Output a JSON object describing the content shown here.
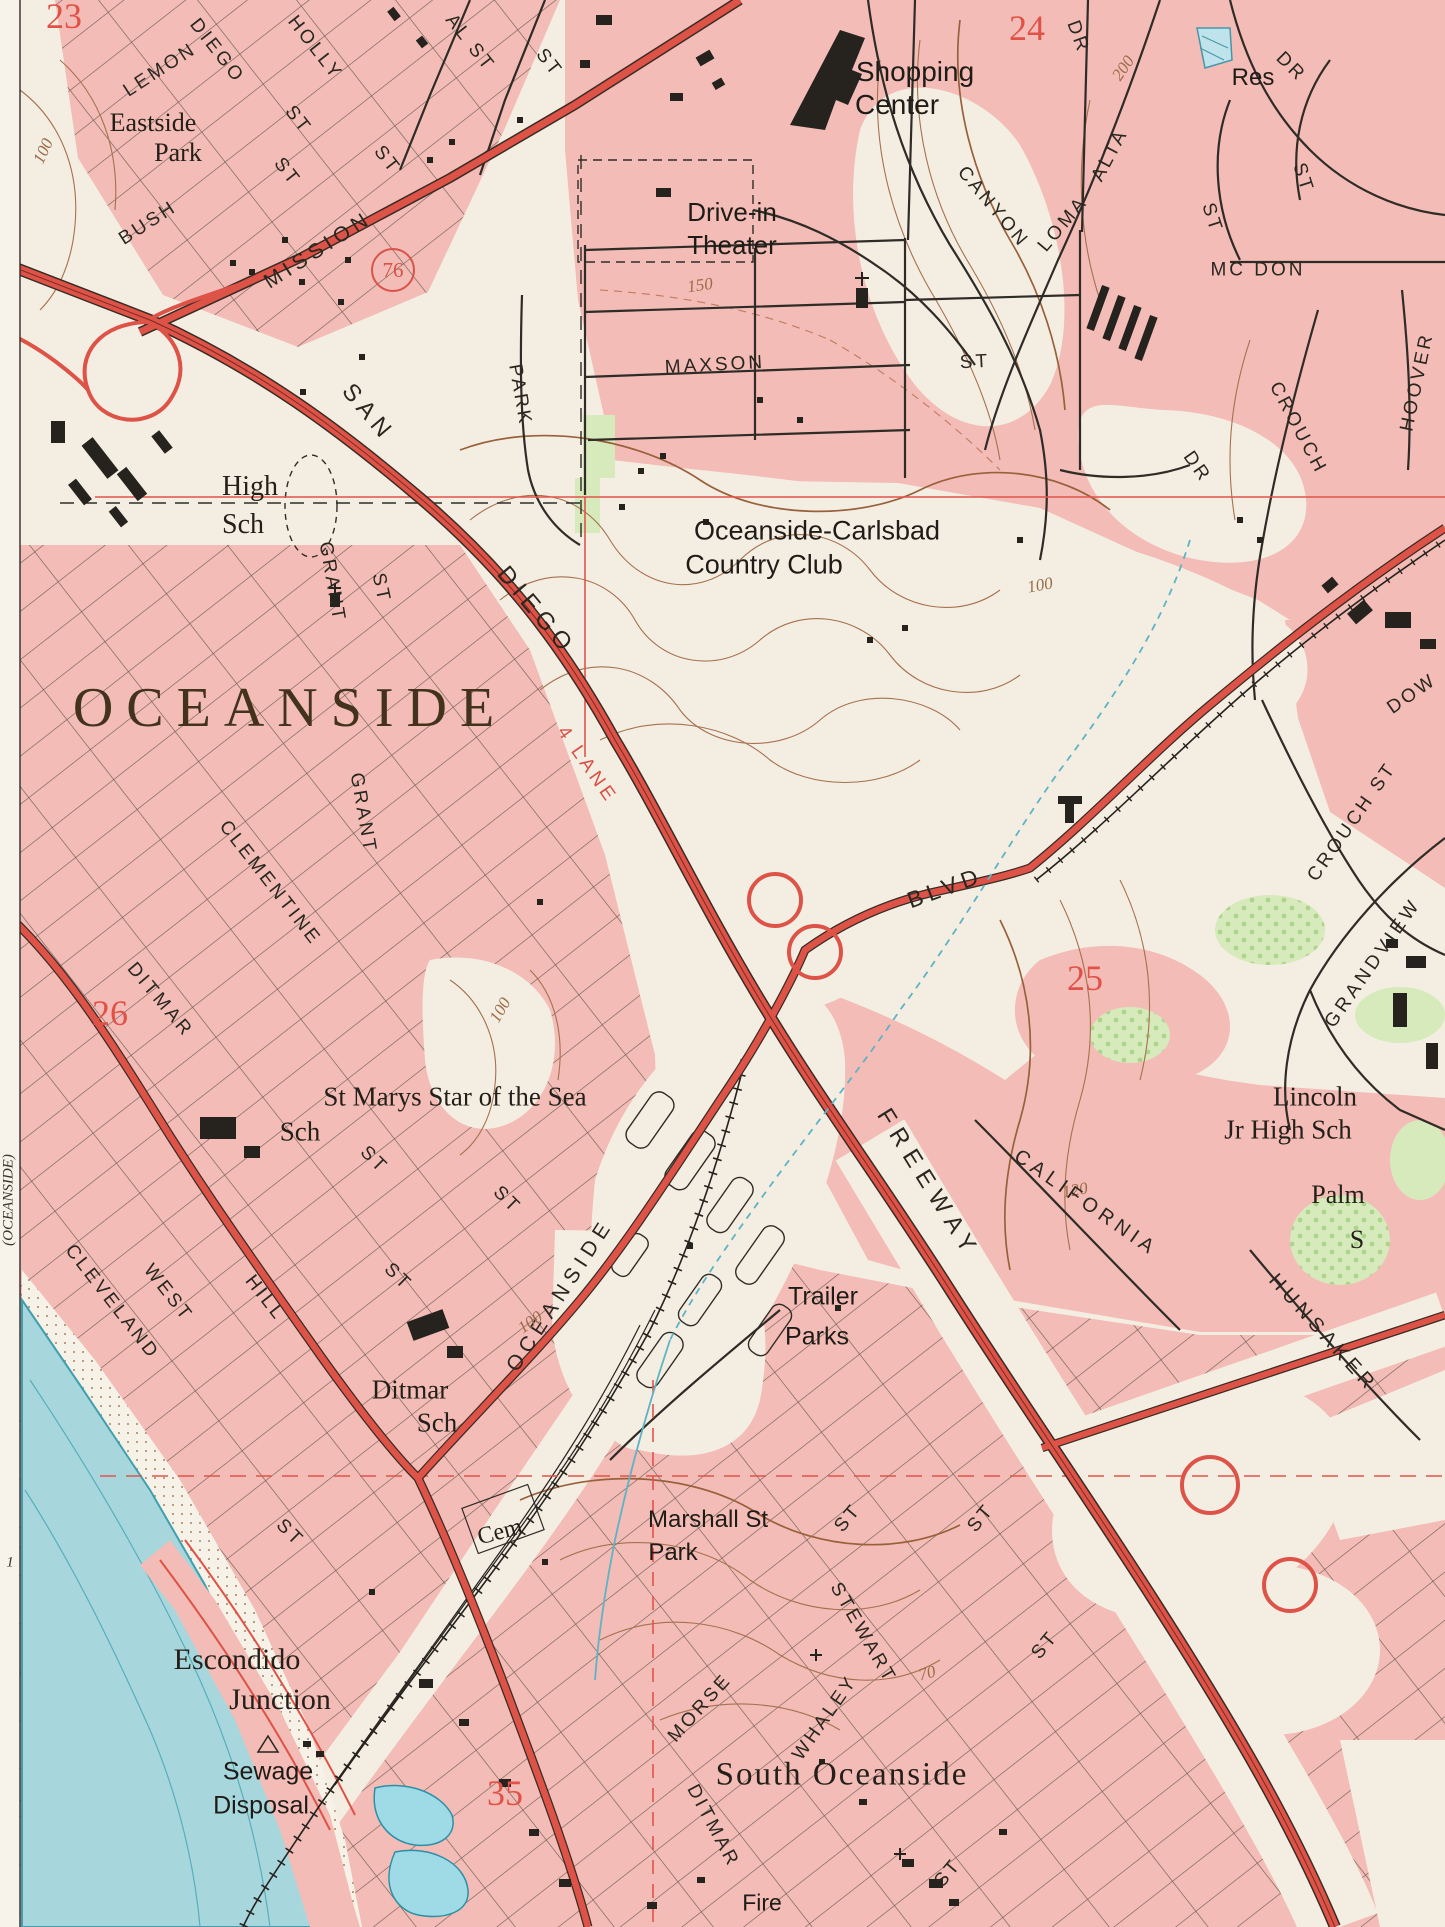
{
  "map": {
    "type": "usgs-topographic-map",
    "region": "Oceanside, California",
    "colors": {
      "paper": "#f4eee2",
      "urban_tint": "#f3bcb6",
      "highway_red": "#dd5348",
      "contour_brown": "#a5714f",
      "water_blue": "#a7d7dc",
      "park_green": "#d7eabc",
      "ink": "#26231f",
      "section_red": "#e05247"
    },
    "route_shield": "76",
    "labels": [
      {
        "id": "sec-23",
        "t": "23",
        "x": 64,
        "y": 16,
        "r": 0,
        "c": "section"
      },
      {
        "id": "st-lemon",
        "t": "LEMON",
        "x": 160,
        "y": 70,
        "r": -33,
        "c": "street"
      },
      {
        "id": "st-diego-n",
        "t": "DIEGO",
        "x": 217,
        "y": 51,
        "r": 52,
        "c": "street"
      },
      {
        "id": "st-holly",
        "t": "HOLLY",
        "x": 315,
        "y": 48,
        "r": 52,
        "c": "street"
      },
      {
        "id": "st-al-st",
        "t": "AL ST",
        "x": 470,
        "y": 43,
        "r": 52,
        "c": "street"
      },
      {
        "id": "st-st1",
        "t": "ST",
        "x": 549,
        "y": 63,
        "r": 52,
        "c": "street"
      },
      {
        "id": "pl-eastside",
        "t": "Eastside",
        "x": 153,
        "y": 123,
        "r": 0,
        "c": "place2",
        "fs": 26
      },
      {
        "id": "pl-eastside2",
        "t": "Park",
        "x": 178,
        "y": 153,
        "r": 0,
        "c": "place2",
        "fs": 26
      },
      {
        "id": "st-st2",
        "t": "ST",
        "x": 298,
        "y": 120,
        "r": 52,
        "c": "street"
      },
      {
        "id": "st-st3",
        "t": "ST",
        "x": 287,
        "y": 172,
        "r": 52,
        "c": "street"
      },
      {
        "id": "st-st4",
        "t": "ST",
        "x": 387,
        "y": 160,
        "r": 52,
        "c": "street"
      },
      {
        "id": "st-bush",
        "t": "BUSH",
        "x": 148,
        "y": 223,
        "r": -33,
        "c": "street"
      },
      {
        "id": "st-mission",
        "t": "MISSION",
        "x": 318,
        "y": 250,
        "r": -33,
        "c": "street",
        "fs": 21,
        "ls": 5
      },
      {
        "id": "route-76",
        "t": "76",
        "x": 393,
        "y": 270,
        "r": 0,
        "c": "route"
      },
      {
        "id": "cont-100a",
        "t": "100",
        "x": 43,
        "y": 151,
        "r": -65,
        "c": "contour"
      },
      {
        "id": "pl-shopping",
        "t": "Shopping",
        "x": 915,
        "y": 72,
        "r": 0,
        "c": "place",
        "fs": 28
      },
      {
        "id": "pl-shopping2",
        "t": "Center",
        "x": 897,
        "y": 105,
        "r": 0,
        "c": "place",
        "fs": 28
      },
      {
        "id": "pl-drivein",
        "t": "Drive-in",
        "x": 732,
        "y": 212,
        "r": 0,
        "c": "place",
        "fs": 26
      },
      {
        "id": "pl-drivein2",
        "t": "Theater",
        "x": 732,
        "y": 245,
        "r": 0,
        "c": "place",
        "fs": 26
      },
      {
        "id": "cont-150",
        "t": "150",
        "x": 700,
        "y": 285,
        "r": -8,
        "c": "contour"
      },
      {
        "id": "st-maxson",
        "t": "MAXSON",
        "x": 715,
        "y": 365,
        "r": -3,
        "c": "street"
      },
      {
        "id": "st-maxson-st",
        "t": "ST",
        "x": 975,
        "y": 362,
        "r": -3,
        "c": "street"
      },
      {
        "id": "sec-24",
        "t": "24",
        "x": 1027,
        "y": 28,
        "r": 0,
        "c": "section"
      },
      {
        "id": "st-canyon",
        "t": "CANYON",
        "x": 993,
        "y": 207,
        "r": 50,
        "c": "street"
      },
      {
        "id": "st-canyon-dr",
        "t": "DR",
        "x": 1078,
        "y": 37,
        "r": 70,
        "c": "street"
      },
      {
        "id": "cont-200",
        "t": "200",
        "x": 1123,
        "y": 68,
        "r": -55,
        "c": "contour"
      },
      {
        "id": "pl-res",
        "t": "Res",
        "x": 1253,
        "y": 78,
        "r": 0,
        "c": "place",
        "fs": 24
      },
      {
        "id": "st-dr2",
        "t": "DR",
        "x": 1291,
        "y": 67,
        "r": 45,
        "c": "street"
      },
      {
        "id": "st-st5",
        "t": "ST",
        "x": 1303,
        "y": 178,
        "r": 72,
        "c": "street"
      },
      {
        "id": "st-st6",
        "t": "ST",
        "x": 1212,
        "y": 218,
        "r": 72,
        "c": "street"
      },
      {
        "id": "st-mcdon",
        "t": "MC DON",
        "x": 1258,
        "y": 270,
        "r": 0,
        "c": "street"
      },
      {
        "id": "st-loma",
        "t": "LOMA",
        "x": 1063,
        "y": 224,
        "r": -50,
        "c": "street"
      },
      {
        "id": "st-alta",
        "t": "ALTA",
        "x": 1110,
        "y": 155,
        "r": -62,
        "c": "street"
      },
      {
        "id": "st-hoover",
        "t": "HOOVER",
        "x": 1417,
        "y": 382,
        "r": -78,
        "c": "street"
      },
      {
        "id": "st-crouch-n",
        "t": "CROUCH",
        "x": 1298,
        "y": 428,
        "r": 62,
        "c": "street"
      },
      {
        "id": "st-dr3",
        "t": "DR",
        "x": 1197,
        "y": 467,
        "r": 55,
        "c": "street"
      },
      {
        "id": "cont-100b",
        "t": "100",
        "x": 1040,
        "y": 585,
        "r": -10,
        "c": "contour"
      },
      {
        "id": "st-dow",
        "t": "DOW",
        "x": 1412,
        "y": 694,
        "r": -35,
        "c": "street"
      },
      {
        "id": "pl-highsch",
        "t": "High",
        "x": 250,
        "y": 487,
        "r": 0,
        "c": "place2",
        "fs": 28
      },
      {
        "id": "pl-highsch2",
        "t": "Sch",
        "x": 243,
        "y": 525,
        "r": 0,
        "c": "place2",
        "fs": 28
      },
      {
        "id": "st-san",
        "t": "SAN",
        "x": 368,
        "y": 413,
        "r": 50,
        "c": "street",
        "fs": 24,
        "ls": 6
      },
      {
        "id": "st-park",
        "t": "PARK",
        "x": 520,
        "y": 395,
        "r": 80,
        "c": "street"
      },
      {
        "id": "st-diego-s",
        "t": "DIEGO",
        "x": 536,
        "y": 611,
        "r": 50,
        "c": "street",
        "fs": 24,
        "ls": 6
      },
      {
        "id": "pl-cc1",
        "t": "Oceanside-Carlsbad",
        "x": 817,
        "y": 531,
        "r": 0,
        "c": "place",
        "fs": 27
      },
      {
        "id": "pl-cc2",
        "t": "Country Club",
        "x": 764,
        "y": 565,
        "r": 0,
        "c": "place",
        "fs": 27
      },
      {
        "id": "pl-city",
        "t": "OCEANSIDE",
        "x": 290,
        "y": 708,
        "r": 0,
        "c": "city"
      },
      {
        "id": "st-grant1",
        "t": "GRANT",
        "x": 332,
        "y": 582,
        "r": 80,
        "c": "street"
      },
      {
        "id": "st-st7",
        "t": "ST",
        "x": 381,
        "y": 588,
        "r": 78,
        "c": "street"
      },
      {
        "id": "st-grant2",
        "t": "GRANT",
        "x": 363,
        "y": 813,
        "r": 80,
        "c": "street"
      },
      {
        "id": "st-clementine",
        "t": "CLEMENTINE",
        "x": 270,
        "y": 883,
        "r": 52,
        "c": "street"
      },
      {
        "id": "lbl-4lane",
        "t": "4 LANE",
        "x": 587,
        "y": 765,
        "r": 55,
        "c": "redroad"
      },
      {
        "id": "st-blvd",
        "t": "BLVD",
        "x": 945,
        "y": 888,
        "r": -20,
        "c": "street",
        "fs": 23,
        "ls": 5
      },
      {
        "id": "sec-25",
        "t": "25",
        "x": 1085,
        "y": 978,
        "r": 0,
        "c": "section"
      },
      {
        "id": "sec-26",
        "t": "26",
        "x": 110,
        "y": 1013,
        "r": 0,
        "c": "section"
      },
      {
        "id": "st-ditmar-n",
        "t": "DITMAR",
        "x": 160,
        "y": 1000,
        "r": 50,
        "c": "street"
      },
      {
        "id": "cont-100c",
        "t": "100",
        "x": 500,
        "y": 1010,
        "r": -60,
        "c": "contour"
      },
      {
        "id": "st-crouch-s",
        "t": "CROUCH ST",
        "x": 1352,
        "y": 822,
        "r": -55,
        "c": "street"
      },
      {
        "id": "st-grandview",
        "t": "GRANDVIEW",
        "x": 1373,
        "y": 963,
        "r": -55,
        "c": "street",
        "fs": 19,
        "ls": 4
      },
      {
        "id": "pl-lincoln1",
        "t": "Lincoln",
        "x": 1315,
        "y": 1097,
        "r": 0,
        "c": "place2",
        "fs": 27
      },
      {
        "id": "pl-lincoln2",
        "t": "Jr High Sch",
        "x": 1288,
        "y": 1130,
        "r": 0,
        "c": "place2",
        "fs": 27
      },
      {
        "id": "cont-120",
        "t": "120",
        "x": 1075,
        "y": 1190,
        "r": -10,
        "c": "contour"
      },
      {
        "id": "pl-palm1",
        "t": "Palm",
        "x": 1338,
        "y": 1195,
        "r": 0,
        "c": "place2",
        "fs": 26
      },
      {
        "id": "pl-palm2",
        "t": "S",
        "x": 1357,
        "y": 1240,
        "r": 0,
        "c": "place2",
        "fs": 26
      },
      {
        "id": "st-freeway",
        "t": "FREEWAY",
        "x": 928,
        "y": 1184,
        "r": 58,
        "c": "street",
        "fs": 24,
        "ls": 8
      },
      {
        "id": "st-california",
        "t": "CALIFORNIA",
        "x": 1086,
        "y": 1203,
        "r": 35,
        "c": "street",
        "fs": 20,
        "ls": 5
      },
      {
        "id": "st-hunsaker",
        "t": "HUNSAKER",
        "x": 1323,
        "y": 1333,
        "r": 48,
        "c": "street",
        "fs": 20,
        "ls": 5
      },
      {
        "id": "pl-stmarys1",
        "t": "St Marys Star of the Sea",
        "x": 455,
        "y": 1097,
        "r": 0,
        "c": "place2",
        "fs": 27
      },
      {
        "id": "pl-stmarys2",
        "t": "Sch",
        "x": 300,
        "y": 1132,
        "r": 0,
        "c": "place2",
        "fs": 27
      },
      {
        "id": "st-st8",
        "t": "ST",
        "x": 374,
        "y": 1160,
        "r": 45,
        "c": "street"
      },
      {
        "id": "st-st9",
        "t": "ST",
        "x": 507,
        "y": 1200,
        "r": 45,
        "c": "street"
      },
      {
        "id": "st-st10",
        "t": "ST",
        "x": 398,
        "y": 1277,
        "r": 45,
        "c": "street"
      },
      {
        "id": "st-west",
        "t": "WEST",
        "x": 168,
        "y": 1293,
        "r": 52,
        "c": "street"
      },
      {
        "id": "st-hill",
        "t": "HILL",
        "x": 265,
        "y": 1298,
        "r": 52,
        "c": "street"
      },
      {
        "id": "st-cleveland",
        "t": "CLEVELAND",
        "x": 112,
        "y": 1302,
        "r": 52,
        "c": "street"
      },
      {
        "id": "st-oceanside-blvd",
        "t": "OCEANSIDE",
        "x": 560,
        "y": 1295,
        "r": -57,
        "c": "street",
        "fs": 21,
        "ls": 6
      },
      {
        "id": "cont-100d",
        "t": "100",
        "x": 530,
        "y": 1322,
        "r": -35,
        "c": "contour"
      },
      {
        "id": "pl-trailer1",
        "t": "Trailer",
        "x": 823,
        "y": 1297,
        "r": 0,
        "c": "place",
        "fs": 25
      },
      {
        "id": "pl-trailer2",
        "t": "Parks",
        "x": 817,
        "y": 1337,
        "r": 0,
        "c": "place",
        "fs": 25
      },
      {
        "id": "pl-ditmarsch1",
        "t": "Ditmar",
        "x": 410,
        "y": 1390,
        "r": 0,
        "c": "place2",
        "fs": 27
      },
      {
        "id": "pl-ditmarsch2",
        "t": "Sch",
        "x": 437,
        "y": 1423,
        "r": 0,
        "c": "place2",
        "fs": 27
      },
      {
        "id": "pl-cem",
        "t": "Cem",
        "x": 500,
        "y": 1532,
        "r": -15,
        "c": "place2",
        "fs": 24
      },
      {
        "id": "st-st11",
        "t": "ST",
        "x": 290,
        "y": 1533,
        "r": 45,
        "c": "street"
      },
      {
        "id": "pl-marshall1",
        "t": "Marshall St",
        "x": 708,
        "y": 1520,
        "r": 0,
        "c": "place",
        "fs": 24
      },
      {
        "id": "pl-marshall2",
        "t": "Park",
        "x": 673,
        "y": 1553,
        "r": 0,
        "c": "place",
        "fs": 24
      },
      {
        "id": "st-st12",
        "t": "ST",
        "x": 848,
        "y": 1518,
        "r": -50,
        "c": "street"
      },
      {
        "id": "st-st13",
        "t": "ST",
        "x": 981,
        "y": 1518,
        "r": -50,
        "c": "street"
      },
      {
        "id": "st-stewart",
        "t": "STEWART",
        "x": 863,
        "y": 1633,
        "r": 60,
        "c": "street"
      },
      {
        "id": "st-whaley",
        "t": "WHALEY",
        "x": 825,
        "y": 1718,
        "r": -55,
        "c": "street"
      },
      {
        "id": "st-morse",
        "t": "MORSE",
        "x": 700,
        "y": 1708,
        "r": -48,
        "c": "street"
      },
      {
        "id": "st-ditmar-s",
        "t": "DITMAR",
        "x": 713,
        "y": 1826,
        "r": 62,
        "c": "street"
      },
      {
        "id": "cont-70",
        "t": "70",
        "x": 927,
        "y": 1673,
        "r": -15,
        "c": "contour"
      },
      {
        "id": "st-st14",
        "t": "ST",
        "x": 1045,
        "y": 1645,
        "r": -50,
        "c": "street"
      },
      {
        "id": "st-st15",
        "t": "ST",
        "x": 948,
        "y": 1873,
        "r": -50,
        "c": "street"
      },
      {
        "id": "pl-southoceanside",
        "t": "South Oceanside",
        "x": 842,
        "y": 1775,
        "r": 0,
        "c": "city2"
      },
      {
        "id": "pl-escondido1",
        "t": "Escondido",
        "x": 237,
        "y": 1660,
        "r": 0,
        "c": "place2",
        "fs": 30
      },
      {
        "id": "pl-escondido2",
        "t": "Junction",
        "x": 280,
        "y": 1700,
        "r": 0,
        "c": "place2",
        "fs": 30
      },
      {
        "id": "pl-sewage1",
        "t": "Sewage",
        "x": 268,
        "y": 1772,
        "r": 0,
        "c": "place",
        "fs": 25
      },
      {
        "id": "pl-sewage2",
        "t": "Disposal",
        "x": 261,
        "y": 1806,
        "r": 0,
        "c": "place",
        "fs": 25
      },
      {
        "id": "sec-35",
        "t": "35",
        "x": 505,
        "y": 1793,
        "r": 0,
        "c": "section"
      },
      {
        "id": "pl-fire",
        "t": "Fire",
        "x": 762,
        "y": 1903,
        "r": 0,
        "c": "place",
        "fs": 23
      },
      {
        "id": "margin-quad",
        "t": "(OCEANSIDE)",
        "x": 9,
        "y": 1200,
        "r": -90,
        "c": "margin"
      },
      {
        "id": "margin-1",
        "t": "1",
        "x": 10,
        "y": 1563,
        "r": 0,
        "c": "margin"
      }
    ]
  }
}
